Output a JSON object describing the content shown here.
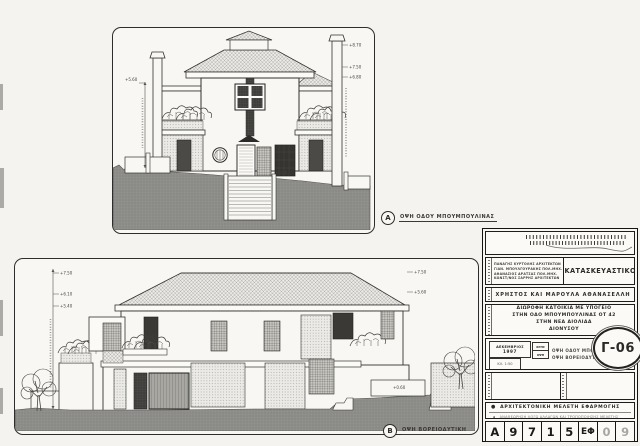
{
  "page": {
    "paper_color": "#f4f3ef",
    "ground_color": "#8e8d8a",
    "ink_color": "#2b2a28"
  },
  "drawing_a": {
    "marker": "A",
    "caption": "ΟΨΗ ΟΔΟΥ ΜΠΟΥΜΠΟΥΛΙΝΑΣ",
    "levels_right": [
      "+8.70",
      "+7.50",
      "+6.80"
    ],
    "levels_left": [
      "+5.60"
    ],
    "ground_note": "±0.00"
  },
  "drawing_b": {
    "marker": "B",
    "caption": "ΟΨΗ ΒΟΡΕΙΟΔΥΤΙΚΗ",
    "levels_left": [
      "+7.50",
      "+6.10",
      "+5.40"
    ],
    "levels_right": [
      "+7.50",
      "+5.60"
    ],
    "ground_note": "+0.60"
  },
  "title_block": {
    "discipline": "ΚΑΤΑΣΚΕΥΑΣΤΙΚΟ",
    "team": [
      "ΠΑΝΑΓΗΣ ΚΥΡΤΟΛΗΣ ΑΡΧΙΤΕΚΤΩΝ",
      "ΓΙΑΝ. ΜΠΟΥΛΓΟΥΡΑΚΗΣ ΠΟΛ.ΜΗΧ.",
      "ΑΘΑΝΑΣΙΟΣ ΔΡΑΤΣΑΣ ΠΟΛ.ΜΗΧ.",
      "ΚΩΝΣΤ/ΝΟΣ ΣΑΡΡΗΣ ΑΡΧΙΤΕΚΤΩΝ"
    ],
    "owner": "ΧΡΗΣΤΟΣ ΚΑΙ ΜΑΡΟΥΛΑ ΑΘΑΝΑΣΕΛΛΗ",
    "project": [
      "ΔΙΩΡΟΦΗ ΚΑΤΟΙΚΙΑ ΜΕ ΥΠΟΓΕΙΟ",
      "ΣΤΗΝ ΟΔΟ ΜΠΟΥΜΠΟΥΛΙΝΑΣ ΟΤ 42",
      "ΣΤΗΝ ΝΕΑ ΑΙΟΛΙΔΑ",
      "ΔΙΟΝΥΣΟΥ"
    ],
    "date_month": "ΔΕΚΕΜΒΡΙΟΣ",
    "date_year": "1997",
    "scale": "ΚΛ. 1:50",
    "tag_top": "ΧΡΗΣ",
    "tag_bottom": "ΟΨΗ",
    "sheet_title": [
      "ΟΨΗ ΟΔΟΥ ΜΠΟΥΜΠΟΥΛΙΝΑΣ",
      "ΟΨΗ ΒΟΡΕΙΟΔΥΤΙΚΗ"
    ],
    "drawing_number": "Γ-06",
    "study_primary": "ΑΡΧΙΤΕΚΤΟΝΙΚΗ ΜΕΛΕΤΗ ΕΦΑΡΜΟΓΗΣ",
    "study_secondary": "ΑΝΑΘΕΩΡΗΣΗ ΛΟΓΩ ΑΛΛΑΓΩΝ ΚΑΙ ΤΡΟΠΟΠΟΙΗΣΗΣ ΜΕΛΕΤΗΣ",
    "code_cells": [
      "A",
      "9",
      "7",
      "1",
      "5",
      "ΕΦ",
      "0",
      "9"
    ]
  }
}
